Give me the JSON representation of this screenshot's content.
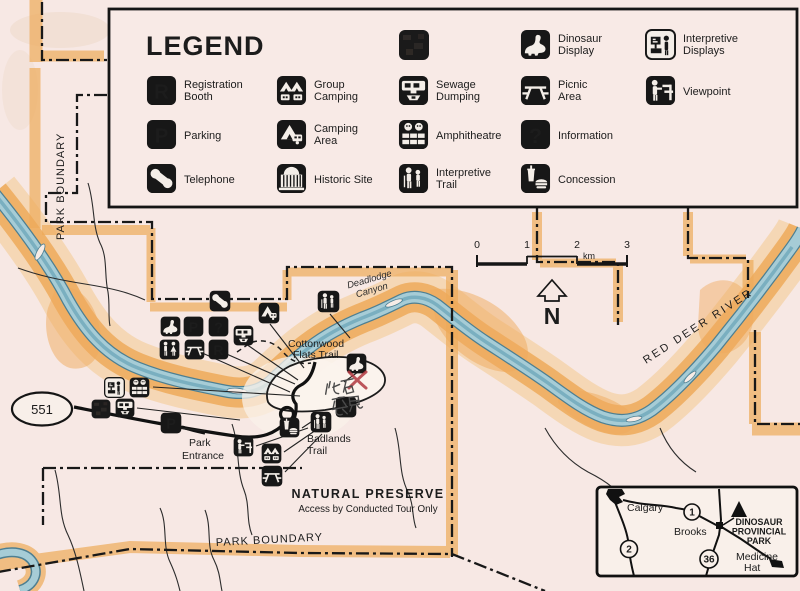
{
  "legend": {
    "title": "LEGEND",
    "items": [
      {
        "icon": "registration-booth",
        "lines": [
          "Registration",
          "Booth"
        ]
      },
      {
        "icon": "parking",
        "lines": [
          "Parking"
        ]
      },
      {
        "icon": "telephone",
        "lines": [
          "Telephone"
        ]
      },
      {
        "icon": "group-camping",
        "lines": [
          "Group",
          "Camping"
        ]
      },
      {
        "icon": "camping-area",
        "lines": [
          "Camping",
          "Area"
        ]
      },
      {
        "icon": "historic-site",
        "lines": [
          "Historic Site"
        ]
      },
      {
        "icon": "sewage-dumping",
        "lines": [
          "Sewage",
          "Dumping"
        ]
      },
      {
        "icon": "amphitheatre",
        "lines": [
          "Amphitheatre"
        ]
      },
      {
        "icon": "interpretive-trail",
        "lines": [
          "Interpretive",
          "Trail"
        ]
      },
      {
        "icon": "dinosaur-display",
        "lines": [
          "Dinosaur",
          "Display"
        ]
      },
      {
        "icon": "picnic-area",
        "lines": [
          "Picnic",
          "Area"
        ]
      },
      {
        "icon": "information",
        "lines": [
          "Information"
        ]
      },
      {
        "icon": "concession",
        "lines": [
          "Concession"
        ]
      },
      {
        "icon": "interpretive-displays",
        "lines": [
          "Interpretive",
          "Displays"
        ]
      },
      {
        "icon": "viewpoint",
        "lines": [
          "Viewpoint"
        ]
      }
    ]
  },
  "icons": {
    "registration_glyph": "R",
    "parking_glyph": "P",
    "information_glyph": "?"
  },
  "scalebar": {
    "ticks": [
      "0",
      "1",
      "2",
      "3"
    ],
    "unit": "km",
    "north": "N"
  },
  "map": {
    "boundary_label_left": "PARK BOUNDARY",
    "boundary_label_bottom": "PARK BOUNDARY",
    "canyon": [
      "Deadlodge",
      "Canyon"
    ],
    "cottonwood_trail": [
      "Cottonwood",
      "Flats Trail"
    ],
    "river_label": "RED DEER RIVER",
    "entrance": [
      "Park",
      "Entrance"
    ],
    "badlands_trail": [
      "Badlands",
      "Trail"
    ],
    "preserve_title": "NATURAL PRESERVE",
    "preserve_subtitle": "Access by Conducted Tour Only",
    "highway_shield": "551"
  },
  "inset": {
    "calgary": "Calgary",
    "brooks": "Brooks",
    "medicine_hat": [
      "Medicine",
      "Hat"
    ],
    "park_name": [
      "DINOSAUR",
      "PROVINCIAL",
      "PARK"
    ],
    "highways": [
      "1",
      "2",
      "36"
    ]
  },
  "annotation": {
    "handwritten_text": "化石發見",
    "mark": "X",
    "color": "#b23a42"
  },
  "colors": {
    "paper": "#f7e8e4",
    "badlands_orange": "#efa452",
    "river_blue": "#a5cbd6",
    "ink": "#1b1b1b",
    "annotation_red": "#b23a42"
  }
}
